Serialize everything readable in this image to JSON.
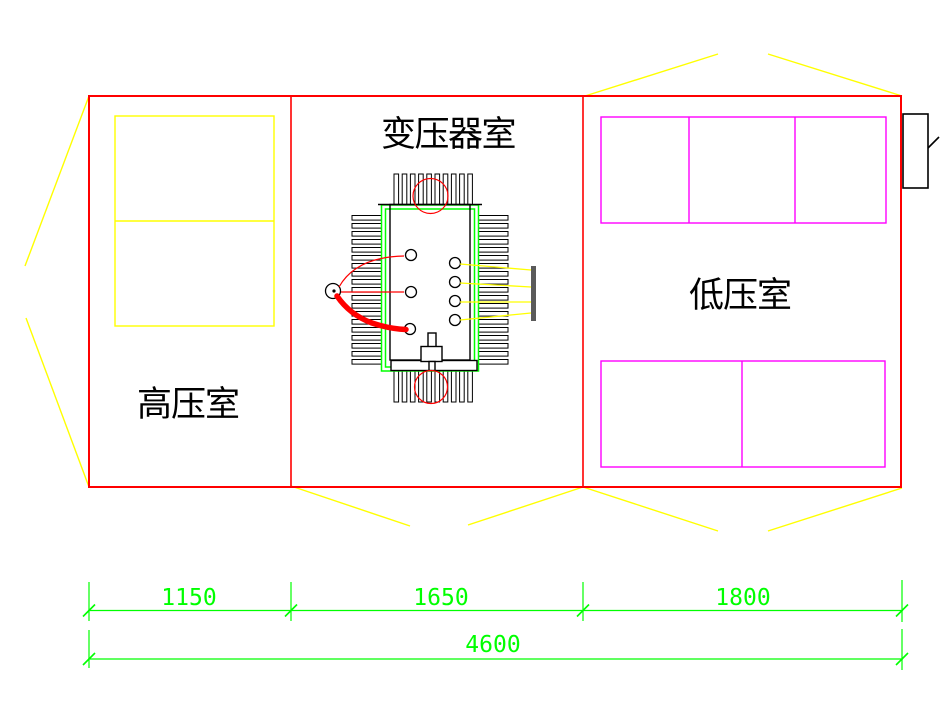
{
  "drawing": {
    "rooms": [
      {
        "label": "高压室"
      },
      {
        "label": "变压器室"
      },
      {
        "label": "低压室"
      }
    ],
    "dimensions": {
      "segments": [
        "1150",
        "1650",
        "1800"
      ],
      "overall": "4600"
    },
    "colors": {
      "wall": "#FF0000",
      "door_swing": "#FFFF00",
      "hv_cabinet": "#FFFF00",
      "lv_cabinet": "#FF00FF",
      "transformer_enclosure": "#00FF00",
      "dimension": "#00FF00",
      "cable": "#FF0000",
      "busbar": "#5A5A5A",
      "detail": "#000000",
      "background": "#FFFFFF"
    }
  }
}
